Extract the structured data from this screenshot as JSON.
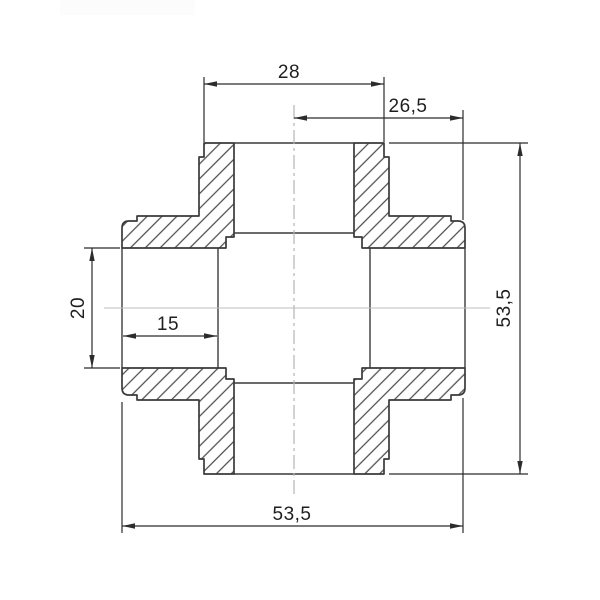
{
  "drawing": {
    "type": "technical-section-cross-fitting",
    "labels": {
      "top_port_width": "28",
      "center_to_right": "26,5",
      "overall_height": "53,5",
      "port_bore": "20",
      "socket_depth": "15",
      "overall_width": "53,5"
    },
    "colors": {
      "outline": "#3a3a3a",
      "hatch": "#4d4d4d",
      "dimension": "#2c2c2c",
      "centerline": "#b5b5b5",
      "background": "#ffffff"
    }
  }
}
